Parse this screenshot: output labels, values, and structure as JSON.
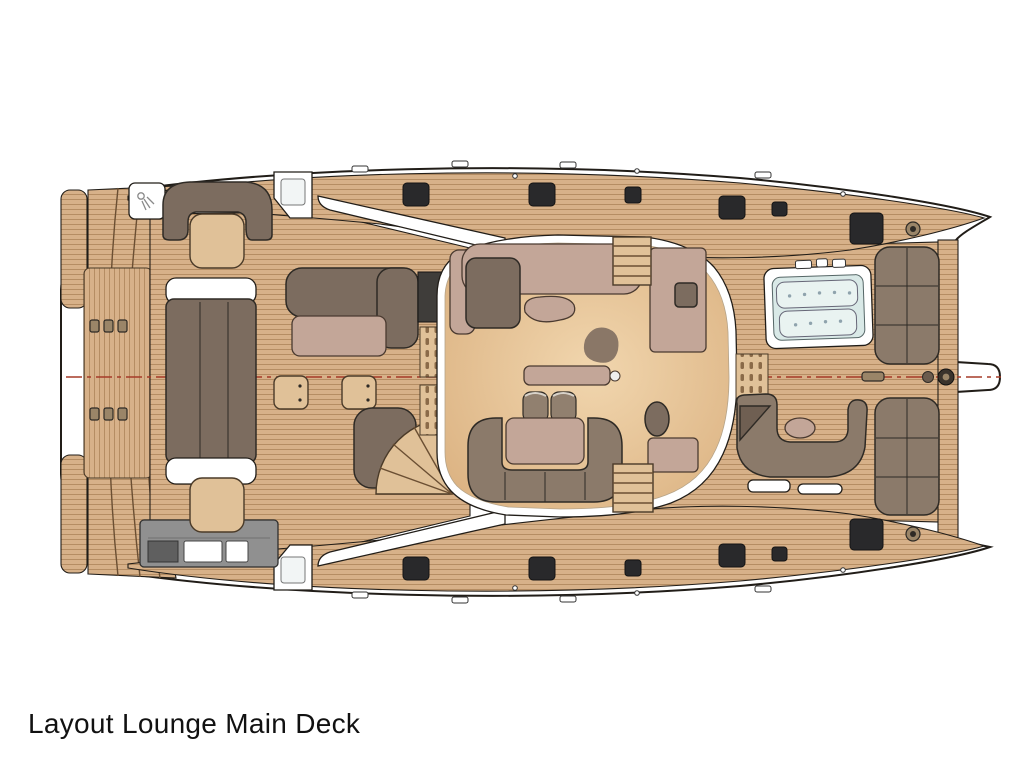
{
  "title": "Layout Lounge Main Deck",
  "palette": {
    "hull_stroke": "#211d18",
    "wood": "#d7b189",
    "wood_line": "#aa8257",
    "wood_light": "#e0c198",
    "floor_center": "#f1d6ae",
    "floor_edge": "#dab07f",
    "sofa_dark": "#7c6c5f",
    "sofa_mid": "#8b7a6a",
    "line_dark": "#2e2a25",
    "mauve": "#c3a698",
    "mauve_dark": "#4a3a30",
    "hatch": "#29292b",
    "galley_gray": "#909090",
    "galley_dark": "#5f5f5f",
    "jacuzzi_water": "#d9e9e7",
    "jacuzzi_seat": "#e9f3f1",
    "centerline": "#a63b28",
    "grate_dark": "#8a6a48"
  }
}
